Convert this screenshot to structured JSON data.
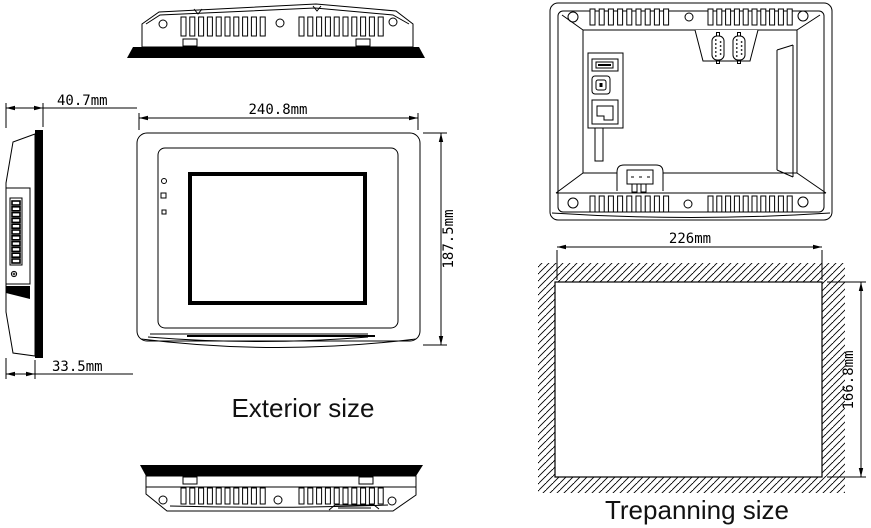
{
  "drawing": {
    "captions": {
      "exterior": "Exterior size",
      "trepanning": "Trepanning size"
    },
    "dimensions": {
      "side_depth_total": "40.7mm",
      "side_depth_body": "33.5mm",
      "front_width": "240.8mm",
      "front_height": "187.5mm",
      "cutout_width": "226mm",
      "cutout_height": "166.8mm"
    },
    "colors": {
      "line": "#000000",
      "background": "#ffffff"
    }
  }
}
